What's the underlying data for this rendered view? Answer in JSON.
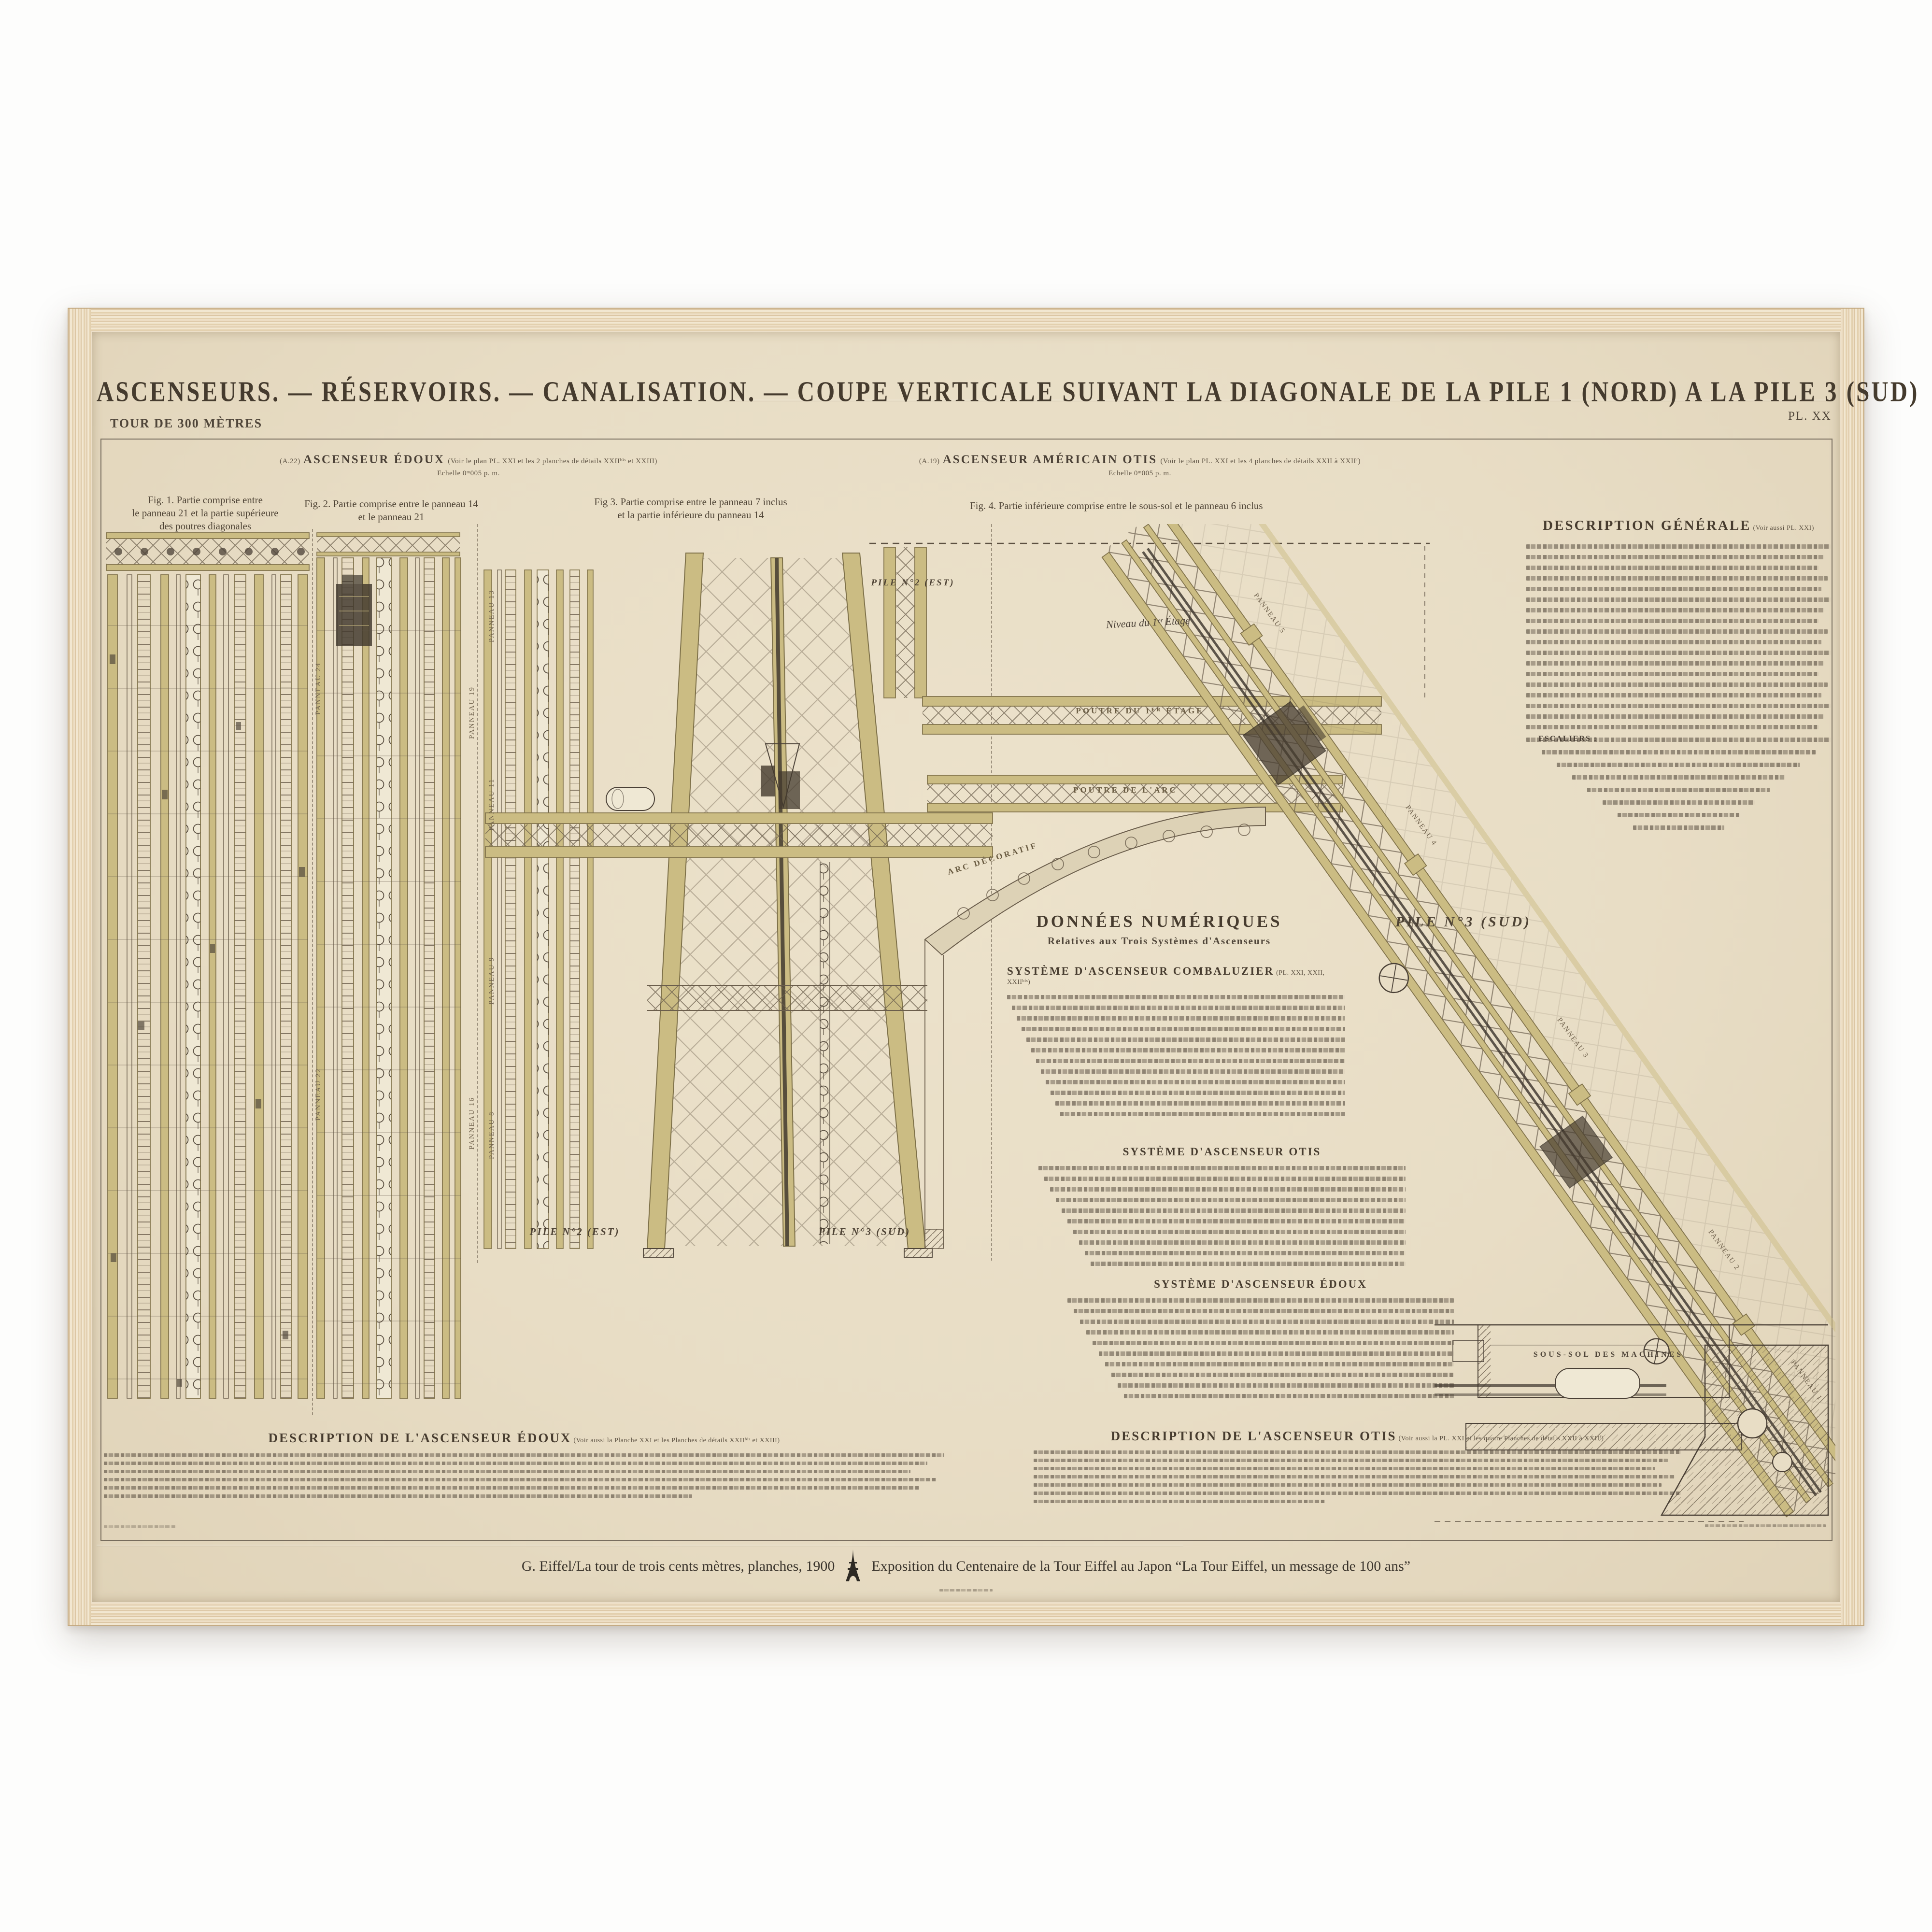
{
  "artwork": {
    "series": "TOUR DE 300 MÈTRES",
    "plate_no": "PL. XX",
    "title": "ASCENSEURS. — RÉSERVOIRS. — CANALISATION. — COUPE VERTICALE SUIVANT LA DIAGONALE DE LA PILE 1 (NORD) A LA PILE 3 (SUD)",
    "systems": {
      "edoux": {
        "ref": "(A.22)",
        "name": "ASCENSEUR ÉDOUX",
        "note": "(Voir le plan PL. XXI et les 2 planches de détails XXIIᵇⁱˢ et XXIII)",
        "scale": "Echelle 0ᵐ005 p. m."
      },
      "otis": {
        "ref": "(A.19)",
        "name": "ASCENSEUR AMÉRICAIN OTIS",
        "note": "(Voir le plan PL. XXI et les 4 planches de détails XXII à XXIIᶠ)",
        "scale": "Echelle 0ᵐ005 p. m."
      }
    },
    "figures": {
      "fig1": [
        "Fig. 1. Partie comprise entre",
        "le panneau 21 et la partie supérieure",
        "des poutres diagonales"
      ],
      "fig2": [
        "Fig. 2. Partie comprise entre le panneau 14",
        "et le panneau 21"
      ],
      "fig3": [
        "Fig 3. Partie comprise entre le panneau 7 inclus",
        "et la partie inférieure du panneau 14"
      ],
      "fig4": [
        "Fig. 4. Partie inférieure comprise entre le sous-sol et le panneau 6 inclus"
      ]
    },
    "labels": {
      "pile2_top": "PILE N°2 (EST)",
      "pile2_fig3": "PILE N°2 (EST)",
      "pile3_fig3": "PILE N°3 (SUD)",
      "pile3_big": "PILE N°3 (SUD)",
      "sous_sol": "SOUS-SOL DES MACHINES",
      "poutre_etage": "POUTRE DU 1ᴱᴿ ÉTAGE",
      "poutre_arc": "POUTRE DE L'ARC",
      "arc_decoratif": "ARC DÉCORATIF",
      "niveau": "Niveau du 1ᵉʳ Étage",
      "panneaux": [
        "PANNEAU 24",
        "PANNEAU 22",
        "PANNEAU 19",
        "PANNEAU 16",
        "PANNEAU 13",
        "PANNEAU 11",
        "PANNEAU 9",
        "PANNEAU 8",
        "PANNEAU 5",
        "PANNEAU 4",
        "PANNEAU 3",
        "PANNEAU 2",
        "PANNEAU 1"
      ]
    },
    "donnees": {
      "title": "DONNÉES NUMÉRIQUES",
      "subtitle": "Relatives aux Trois Systèmes d'Ascenseurs",
      "sec1": "SYSTÈME D'ASCENSEUR COMBALUZIER",
      "sec1_note": "(PL. XXI, XXII, XXIIᵇⁱˢ)",
      "sec2": "SYSTÈME D'ASCENSEUR OTIS",
      "sec3": "SYSTÈME D'ASCENSEUR ÉDOUX"
    },
    "desc_generale": {
      "title": "DESCRIPTION GÉNÉRALE",
      "note": "(Voir aussi PL. XXI)",
      "escaliers": "ESCALIERS :"
    },
    "desc_edoux": {
      "title": "DESCRIPTION DE L'ASCENSEUR ÉDOUX",
      "note": "(Voir aussi la Planche XXI et les Planches de détails XXIIᵇⁱˢ et XXIII)"
    },
    "desc_otis": {
      "title": "DESCRIPTION DE L'ASCENSEUR OTIS",
      "note": "(Voir aussi la PL. XXI et les quatre Planches de détails XXII à XXIIᶠ)"
    },
    "caption": {
      "left": "G. Eiffel/La tour de trois cents mètres, planches, 1900",
      "right": "Exposition du Centenaire de la Tour Eiffel au Japon “La Tour Eiffel, un message de 100 ans”"
    },
    "colors": {
      "paper": "#e8ddc5",
      "ink": "#4a4036",
      "beam": "#cbbc83",
      "frame_wood": "#e8d6b9"
    }
  }
}
